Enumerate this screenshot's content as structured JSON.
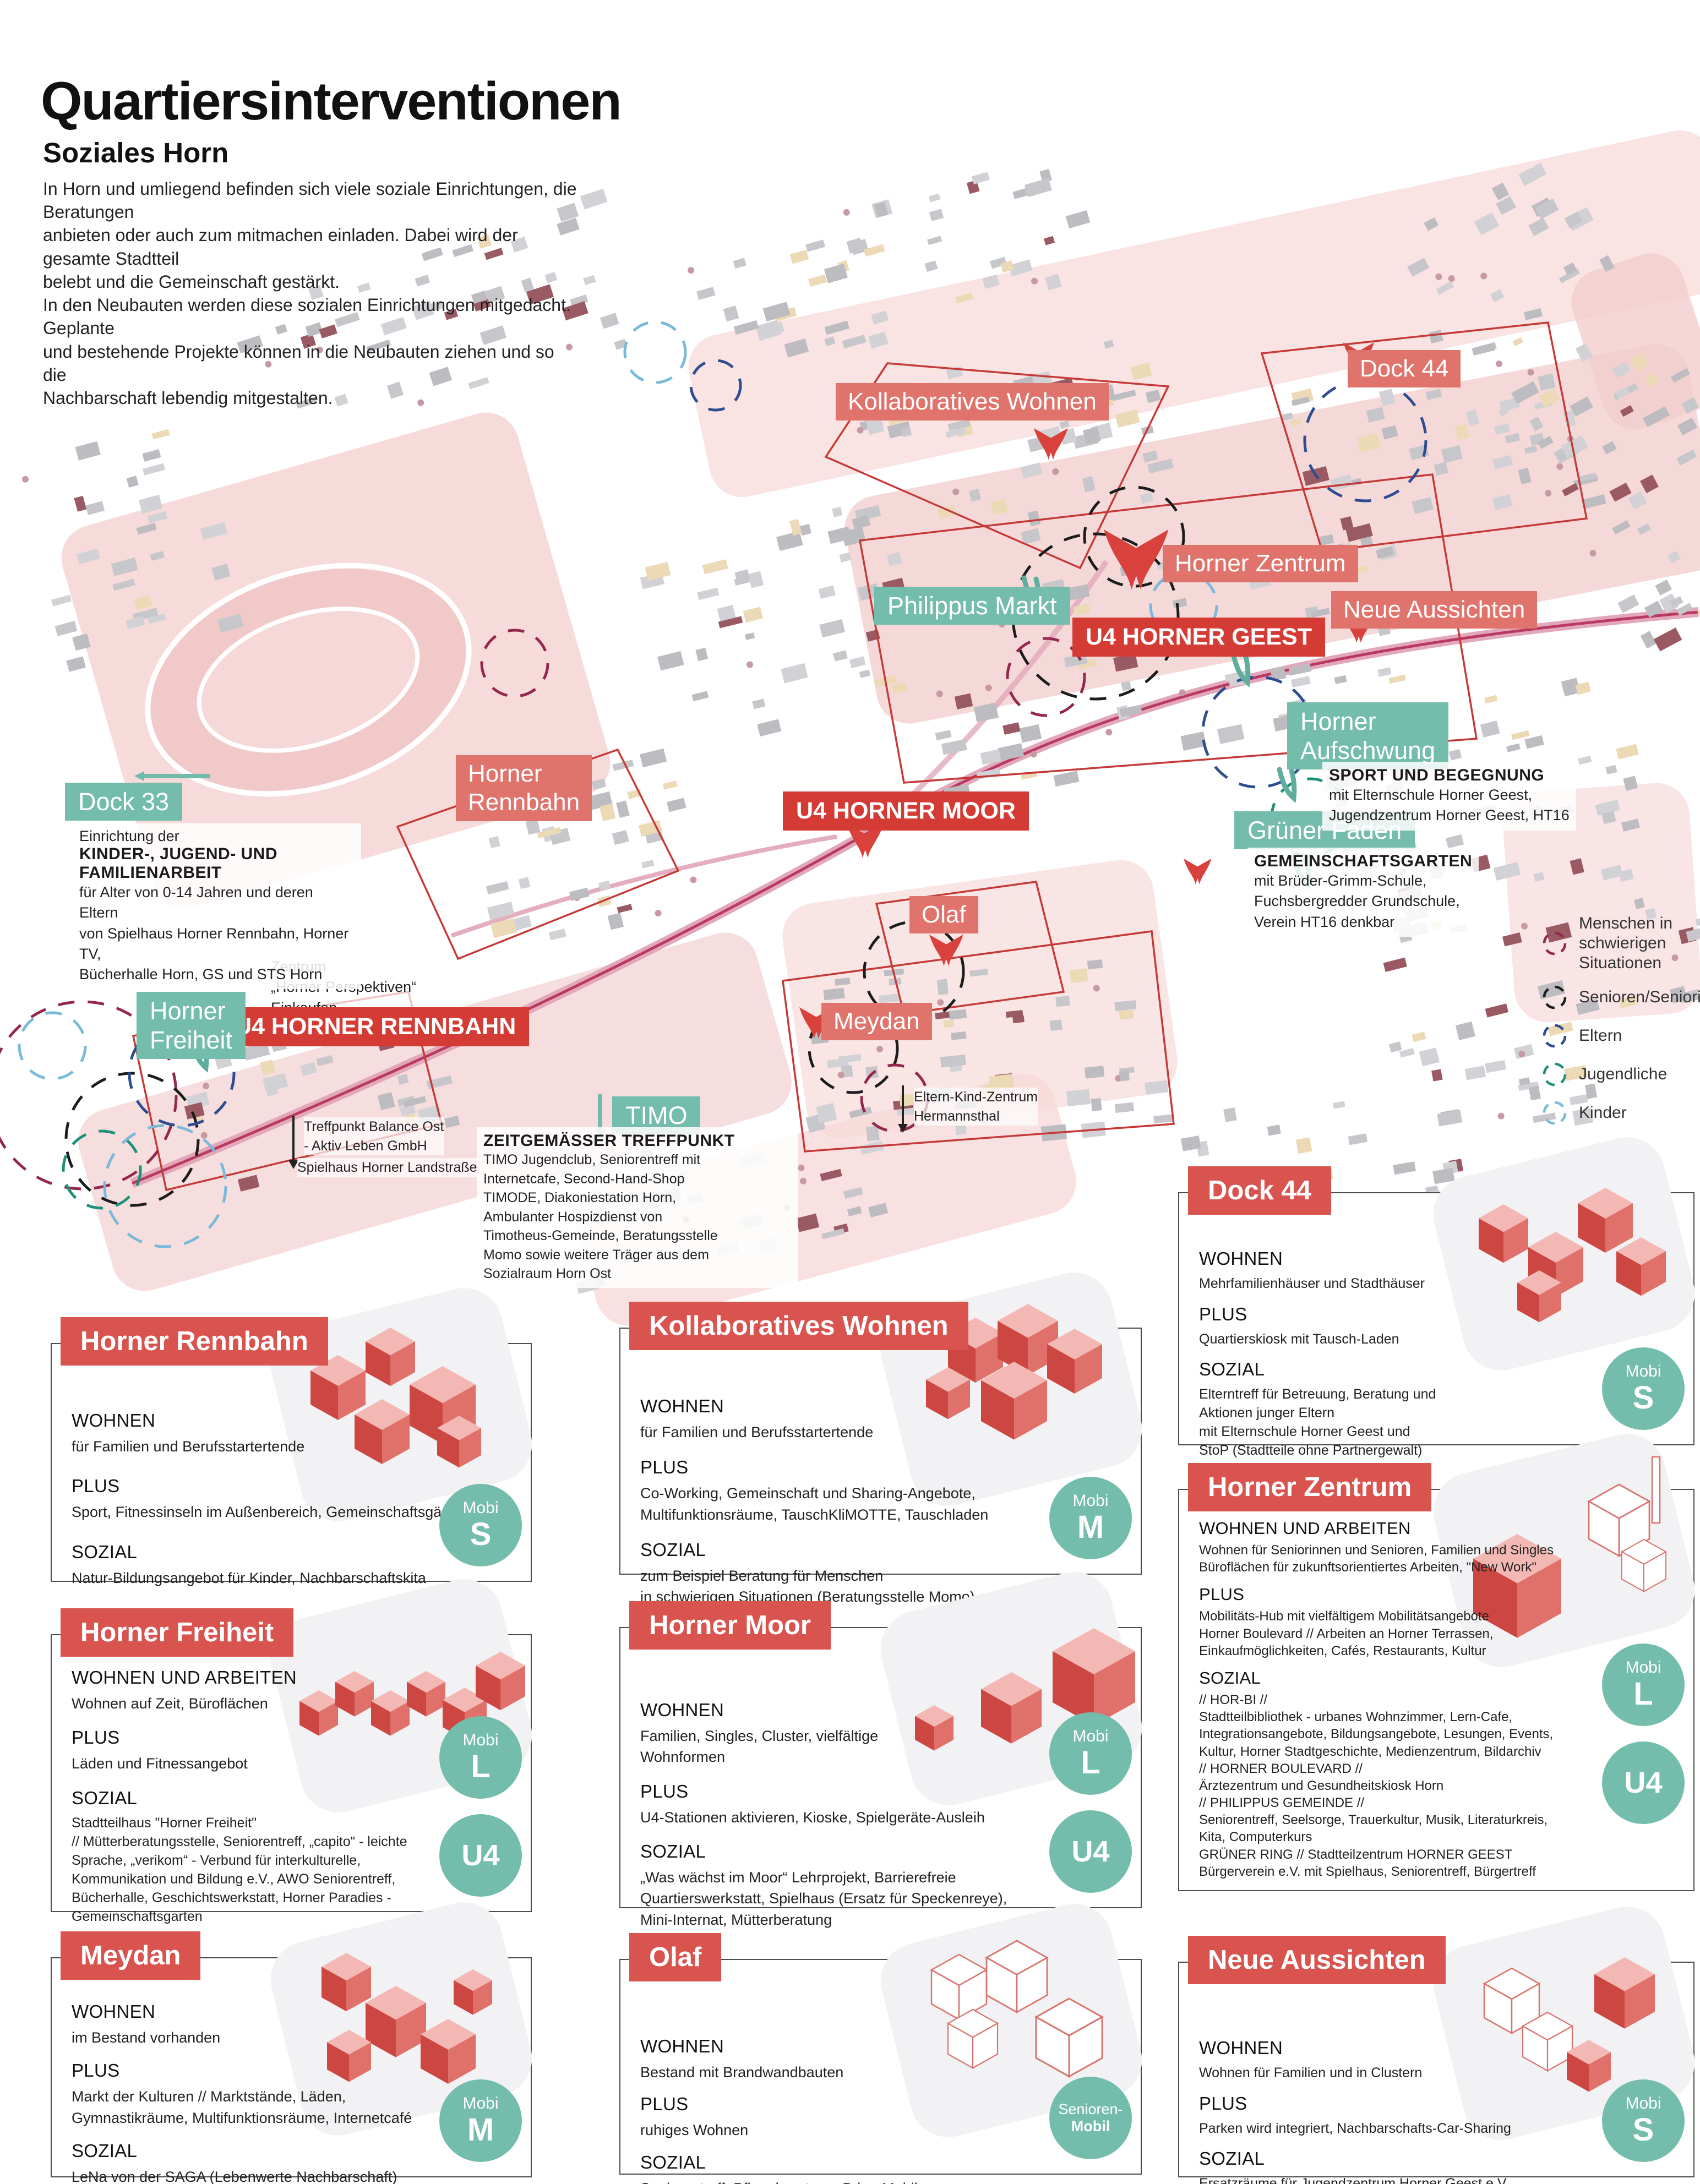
{
  "poster": {
    "title": "Quartiersinterventionen",
    "subtitle": "Soziales Horn",
    "intro": "In Horn und umliegend befinden sich viele soziale Einrichtungen, die Beratungen\nanbieten oder auch zum mitmachen einladen.  Dabei wird der gesamte  Stadtteil\nbelebt und die Gemeinschaft  gestärkt.\nIn den Neubauten werden diese sozialen Einrichtungen mitgedacht. Geplante\nund bestehende Projekte können in die Neubauten ziehen und so die\nNachbarschaft lebendig mitgestalten."
  },
  "colors": {
    "card_chip_red": "#d9534f",
    "map_label_salmon": "#e0736c",
    "map_label_red": "#d43b34",
    "teal": "#74bdac",
    "map_pink": "#f6d8d8",
    "boundary_red": "#c53a38"
  },
  "map": {
    "labels": {
      "dock33": "Dock 33",
      "horner_rennbahn": "Horner\nRennbahn",
      "u4_rennbahn": "U4 HORNER RENNBAHN",
      "horner_freiheit": "Horner\nFreiheit",
      "timo": "TIMO",
      "meydan": "Meydan",
      "olaf": "Olaf",
      "u4_moor": "U4 HORNER MOOR",
      "kollaboratives_wohnen": "Kollaboratives Wohnen",
      "dock44": "Dock 44",
      "horner_zentrum": "Horner Zentrum",
      "philippus_markt": "Philippus Markt",
      "neue_aussichten": "Neue Aussichten",
      "u4_geest": "U4 HORNER GEEST",
      "horner_aufschwung": "Horner\nAufschwung",
      "gruener_faden": "Grüner Faden"
    },
    "notes": {
      "dock33_intro": "Einrichtung der",
      "dock33_title": "KINDER-, JUGEND- UND FAMILIENARBEIT",
      "dock33_body": "für Alter von 0-14 Jahren und deren Eltern\nvon Spielhaus Horner Rennbahn, Horner TV,\nBücherhalle Horn, GS und STS Horn",
      "zentrum": "Zentrum\n„Horner Perspektiven“\nEinkaufen",
      "treffpunkt": "Treffpunkt Balance Ost\n- Aktiv Leben GmbH",
      "spielhaus": "Spielhaus Horner Landstraße",
      "ekz": "Eltern-Kind-Zentrum\nHermannsthal",
      "timo_title": "ZEITGEMÄSSER TREFFPUNKT",
      "timo_body": "TIMO Jugendclub, Seniorentreff mit\nInternetcafe, Second-Hand-Shop\nTIMODE, Diakoniestation Horn,\nAmbulanter Hospizdienst von\nTimotheus-Gemeinde, Beratungsstelle\nMomo sowie weitere Träger aus dem\nSozialraum Horn Ost",
      "sport_title": "SPORT UND BEGEGNUNG",
      "sport_body": "mit Elternschule Horner Geest,\nJugendzentrum Horner Geest, HT16",
      "garten_title": "GEMEINSCHAFTSGARTEN",
      "garten_body": "mit Brüder-Grimm-Schule,\nFuchsbergredder Grundschule,\nVerein HT16 denkbar"
    },
    "legend": [
      {
        "label": "Menschen in\nschwierigen Situationen",
        "color": "#93274e"
      },
      {
        "label": "Senioren/Seniorinnen",
        "color": "#1c1c1c"
      },
      {
        "label": "Eltern",
        "color": "#2e4d8f"
      },
      {
        "label": "Jugendliche",
        "color": "#1f8f7a"
      },
      {
        "label": "Kinder",
        "color": "#79b9d9"
      }
    ]
  },
  "cards": [
    {
      "title": "Horner Rennbahn",
      "sections": [
        {
          "heading": "WOHNEN",
          "body": "für Familien und Berufsstartertende"
        },
        {
          "heading": "PLUS",
          "body": "Sport, Fitnessinseln im Außenbereich, Gemeinschaftsgärten"
        },
        {
          "heading": "SOZIAL",
          "body": "Natur-Bildungsangebot für Kinder, Nachbarschaftskita"
        }
      ],
      "badges": [
        {
          "top": "Mobi",
          "main": "S"
        }
      ]
    },
    {
      "title": "Horner Freiheit",
      "sections": [
        {
          "heading": "WOHNEN UND ARBEITEN",
          "body": "Wohnen auf Zeit, Büroflächen"
        },
        {
          "heading": "PLUS",
          "body": "Läden und Fitnessangebot"
        },
        {
          "heading": "SOZIAL",
          "body": "Stadtteilhaus \"Horner Freiheit\"\n// Mütterberatungsstelle, Seniorentreff, „capito“ - leichte\nSprache, „verikom“ - Verbund für interkulturelle,\nKommunikation und Bildung e.V., AWO Seniorentreff,\nBücherhalle, Geschichtswerkstatt, Horner Paradies -\nGemeinschaftsgarten"
        }
      ],
      "badges": [
        {
          "top": "Mobi",
          "main": "L"
        },
        {
          "main": "U4"
        }
      ]
    },
    {
      "title": "Meydan",
      "sections": [
        {
          "heading": "WOHNEN",
          "body": "im Bestand vorhanden"
        },
        {
          "heading": "PLUS",
          "body": "Markt der Kulturen // Marktstände, Läden,\nGymnastikräume, Multifunktionsräume, Internetcafé"
        },
        {
          "heading": "SOZIAL",
          "body": "LeNa von der SAGA (Lebenwerte Nachbarschaft)\nAWO Seniorengruppe, Nachbarschaftstreff,\nSprachförderung"
        }
      ],
      "badges": [
        {
          "top": "Mobi",
          "main": "M"
        }
      ]
    },
    {
      "title": "Kollaboratives Wohnen",
      "sections": [
        {
          "heading": "WOHNEN",
          "body": "für Familien und Berufsstartertende"
        },
        {
          "heading": "PLUS",
          "body": "Co-Working, Gemeinschaft und Sharing-Angebote,\nMultifunktionsräume, TauschKliMOTTE, Tauschladen"
        },
        {
          "heading": "SOZIAL",
          "body": "zum Beispiel Beratung für Menschen\nin schwierigen Situationen (Beratungsstelle Momo)"
        }
      ],
      "badges": [
        {
          "top": "Mobi",
          "main": "M"
        }
      ]
    },
    {
      "title": "Horner Moor",
      "sections": [
        {
          "heading": "WOHNEN",
          "body": "Familien, Singles, Cluster, vielfältige\nWohnformen"
        },
        {
          "heading": "PLUS",
          "body": "U4-Stationen aktivieren, Kioske, Spielgeräte-Ausleih"
        },
        {
          "heading": "SOZIAL",
          "body": "„Was wächst im Moor“ Lehrprojekt, Barrierefreie\nQuartierswerkstatt, Spielhaus (Ersatz für Speckenreye),\nMini-Internat, Mütterberatung"
        }
      ],
      "badges": [
        {
          "top": "Mobi",
          "main": "L"
        },
        {
          "main": "U4"
        }
      ]
    },
    {
      "title": "Olaf",
      "sections": [
        {
          "heading": "WOHNEN",
          "body": "Bestand mit Brandwandbauten"
        },
        {
          "heading": "PLUS",
          "body": "ruhiges Wohnen"
        },
        {
          "heading": "SOZIAL",
          "body": "Seniorentreff, Pflegeberatung, Bring-Mobil"
        }
      ],
      "badges": [
        {
          "top": "Senioren-",
          "main": "Mobil"
        }
      ]
    },
    {
      "title": "Dock 44",
      "sections": [
        {
          "heading": "WOHNEN",
          "body": "Mehrfamilienhäuser und Stadthäuser"
        },
        {
          "heading": "PLUS",
          "body": "Quartierskiosk mit Tausch-Laden"
        },
        {
          "heading": "SOZIAL",
          "body": "Elterntreff für Betreuung, Beratung und\nAktionen junger Eltern\nmit Elternschule Horner Geest und\nStoP (Stadtteile ohne Partnergewalt)"
        }
      ],
      "badges": [
        {
          "top": "Mobi",
          "main": "S"
        }
      ]
    },
    {
      "title": "Horner Zentrum",
      "sections": [
        {
          "heading": "WOHNEN UND ARBEITEN",
          "body": "Wohnen für Seniorinnen und Senioren, Familien und Singles\nBüroflächen für zukunftsorientiertes Arbeiten, \"New Work\""
        },
        {
          "heading": "PLUS",
          "body": "Mobilitäts-Hub mit vielfältigem Mobilitätsangebote\nHorner Boulevard // Arbeiten an Horner Terrassen,\nEinkaufmöglichkeiten, Cafés, Restaurants, Kultur"
        },
        {
          "heading": "SOZIAL",
          "body": "// HOR-BI //\nStadtteilbibliothek - urbanes Wohnzimmer, Lern-Cafe,\nIntegrationsangebote, Bildungsangebote, Lesungen, Events,\nKultur, Horner Stadtgeschichte, Medienzentrum, Bildarchiv\n// HORNER BOULEVARD //\nÄrztezentrum und Gesundheitskiosk Horn\n// PHILIPPUS GEMEINDE //\nSeniorentreff, Seelsorge, Trauerkultur, Musik, Literaturkreis,\nKita, Computerkurs\nGRÜNER RING // Stadtteilzentrum HORNER GEEST\nBürgerverein e.V. mit Spielhaus, Seniorentreff, Bürgertreff"
        }
      ],
      "badges": [
        {
          "top": "Mobi",
          "main": "L"
        },
        {
          "main": "U4"
        }
      ]
    },
    {
      "title": "Neue Aussichten",
      "sections": [
        {
          "heading": "WOHNEN",
          "body": "Wohnen für Familien und in Clustern"
        },
        {
          "heading": "PLUS",
          "body": "Parken wird integriert, Nachbarschafts-Car-Sharing"
        },
        {
          "heading": "SOZIAL",
          "body": "Ersatzräume für Jugendzentrum Horner Geest e.V. ,\nKinder-Bildungs-Café, Kita, Quartierskiosk"
        }
      ],
      "badges": [
        {
          "top": "Mobi",
          "main": "S"
        }
      ]
    }
  ]
}
